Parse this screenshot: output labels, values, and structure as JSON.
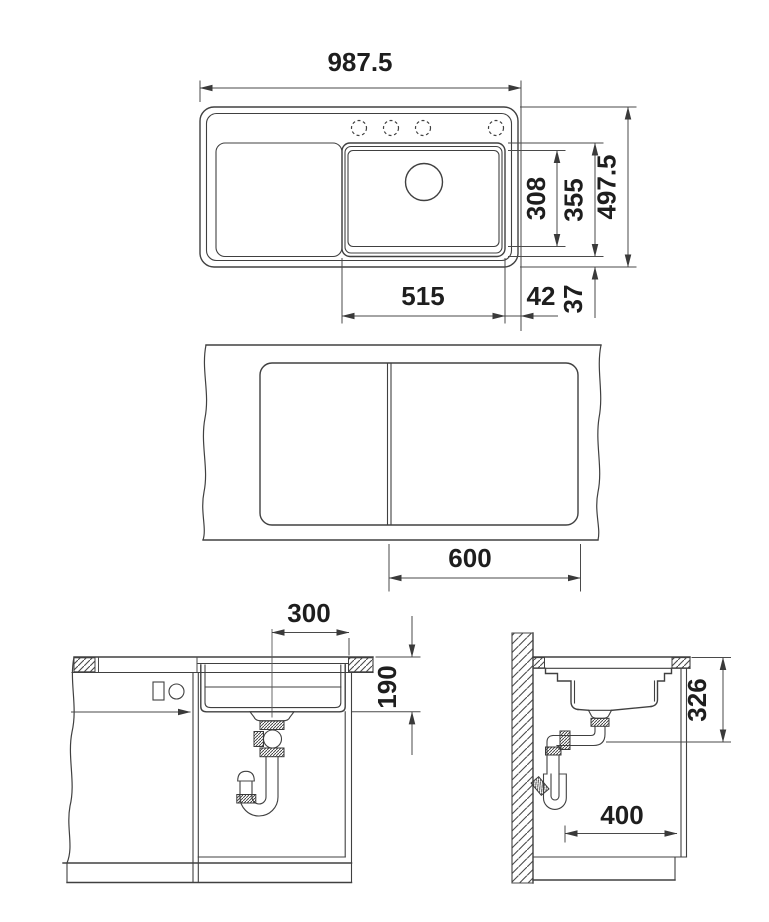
{
  "views": {
    "sink_top": {
      "overall_width": "987.5",
      "bowl_inner_depth": "308",
      "bowl_outer_depth": "355",
      "overall_depth": "497.5",
      "bowl_width": "515",
      "bowl_side_gap": "42",
      "bowl_front_gap": "37"
    },
    "worktop_top": {
      "cabinet_width": "600"
    },
    "front_section": {
      "drain_center_offset": "300",
      "bowl_depth_below_top": "190"
    },
    "side_section": {
      "clearance_depth": "326",
      "drain_wall_distance": "400"
    }
  }
}
